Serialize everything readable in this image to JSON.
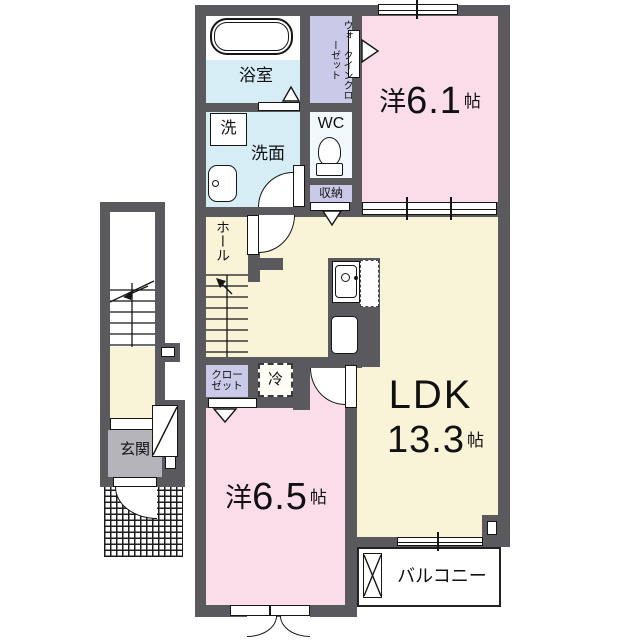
{
  "plan_type": "floorplan",
  "rooms": {
    "bathroom": {
      "label": "浴室"
    },
    "walk_in_closet": {
      "label": "ウォークインクローゼット"
    },
    "washer": {
      "label": "洗"
    },
    "washroom": {
      "label": "洗面"
    },
    "wc": {
      "label": "WC"
    },
    "storage": {
      "label": "収納"
    },
    "hall": {
      "label": "ホール"
    },
    "western_room_1": {
      "prefix": "洋",
      "size": "6.1",
      "unit": "帖"
    },
    "ldk": {
      "name": "LDK",
      "size": "13.3",
      "unit": "帖"
    },
    "closet": {
      "line1": "クロー",
      "line2": "ゼット"
    },
    "refrigerator": {
      "label": "冷"
    },
    "western_room_2": {
      "prefix": "洋",
      "size": "6.5",
      "unit": "帖"
    },
    "entrance": {
      "label": "玄関"
    },
    "balcony": {
      "label": "バルコニー"
    }
  },
  "colors": {
    "wall": "#5a595e",
    "room_pink": "#fbdde9",
    "room_cream": "#f9f3d8",
    "room_blue": "#d7edf6",
    "room_lavender": "#cbc9e8",
    "entrance_gray": "#b5b4ba",
    "wc_white": "#f2f9fc"
  }
}
